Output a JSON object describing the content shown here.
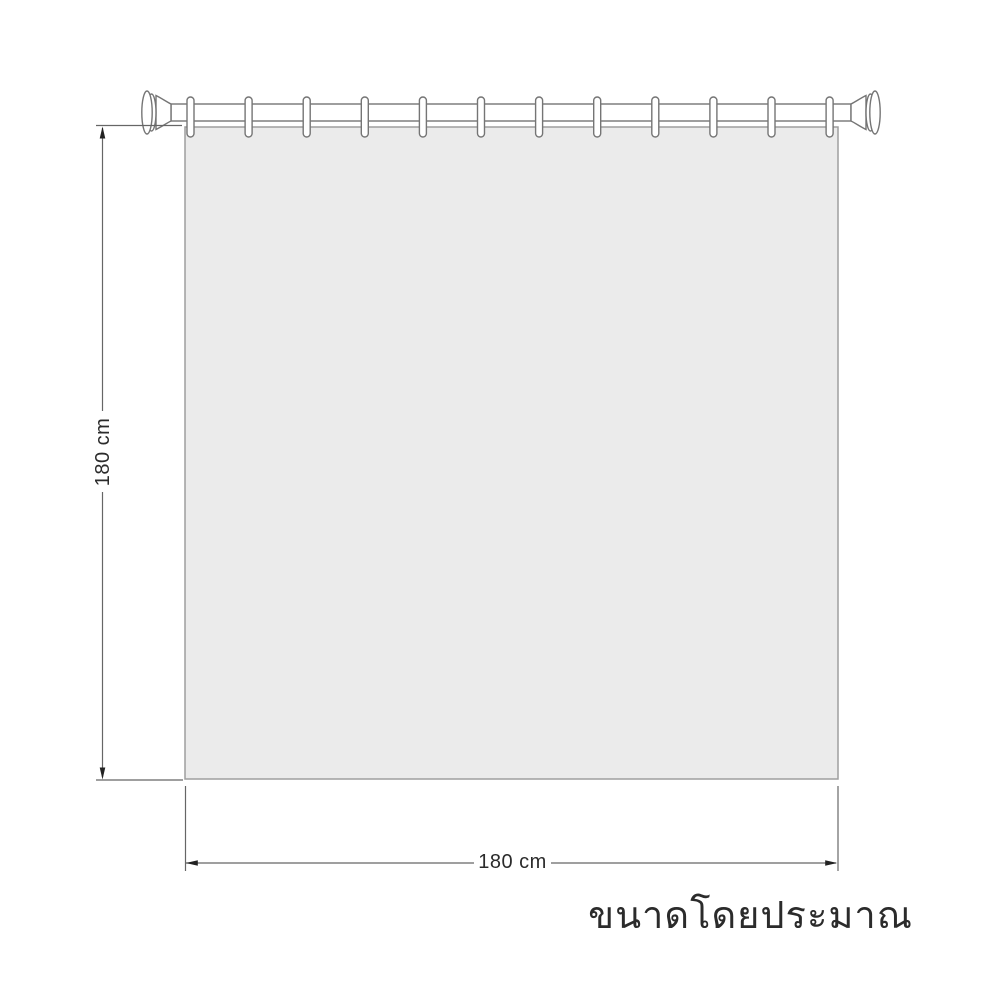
{
  "labels": {
    "height": "180 cm",
    "width": "180 cm"
  },
  "caption": "ขนาดโดยประมาณ",
  "diagram": {
    "subject": "shower-curtain-with-tension-rod",
    "hook_count": 12
  },
  "colors": {
    "background": "#ffffff",
    "curtain_fill": "#ebebeb",
    "curtain_border": "#9e9e9e",
    "hardware_outline": "#757575",
    "dimension_line": "#666666",
    "arrow": "#222222",
    "text": "#2b2b2b"
  }
}
